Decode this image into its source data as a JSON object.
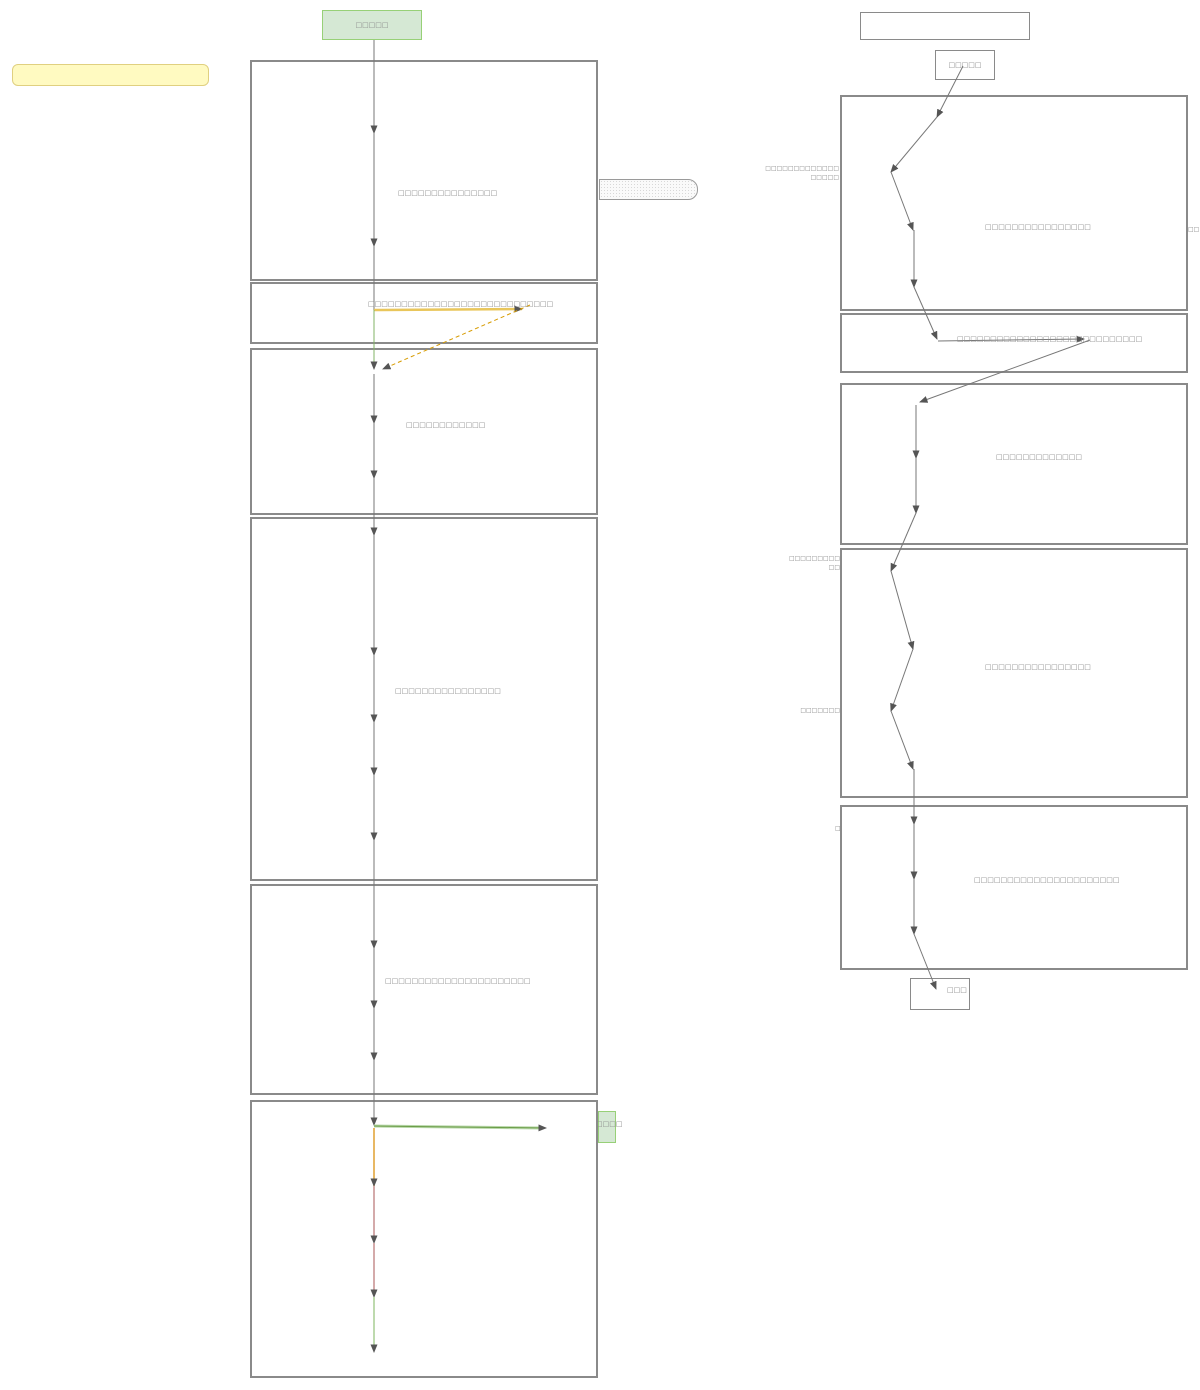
{
  "diagram": {
    "left": {
      "start": "□□□□□",
      "sticky_note": "",
      "box1": "□□□□□□□□□□□□□□□",
      "band": "□□□□□□□□□□□□□□□□□□□□□□□□□□□□",
      "box3": "□□□□□□□□□□□□",
      "box4": "□□□□□□□□□□□□□□□□",
      "box5": "□□□□□□□□□□□□□□□□□□□□□□",
      "tag": "□□□□"
    },
    "right": {
      "header": "",
      "start": "□□□□□",
      "box1": "□□□□□□□□□□□□□□□□",
      "band": "□□□□□□□□□□□□□□□□□□□□□□□□□□□□",
      "box3": "□□□□□□□□□□□□□",
      "box4": "□□□□□□□□□□□□□□□□",
      "box5": "□□□□□□□□□□□□□□□□□□□□□□",
      "end": "□□□",
      "side_a1": "□□□□□□□□□□□□□",
      "side_a2": "□□□□□",
      "side_b1": "□□□□□□□□□",
      "side_b2": "□□",
      "side_c": "□□□□□□□",
      "side_d": "□",
      "edge": "□□"
    },
    "colors": {
      "box_border": "#8a8a8a",
      "start_fill": "#d5e8d4",
      "start_border": "#97d077",
      "sticky_fill": "#fffac1",
      "sticky_border": "#e0d080",
      "arrow_gray": "#777777",
      "arrow_yellow": "#e9c65b",
      "arrow_orange_dashed": "#d79b00",
      "arrow_green": "#82b366",
      "arrow_amber": "#e0a030",
      "arrow_red": "#a85454",
      "arrowhead": "#555555"
    }
  }
}
